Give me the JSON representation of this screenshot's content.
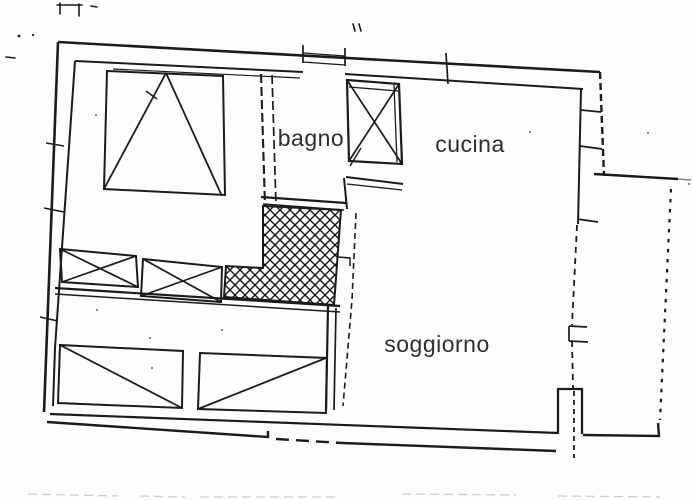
{
  "plan": {
    "rooms": [
      {
        "id": "bagno",
        "label": "bagno"
      },
      {
        "id": "cucina",
        "label": "cucina"
      },
      {
        "id": "soggiorno",
        "label": "soggiorno"
      }
    ]
  },
  "colors": {
    "ink": "#1b1b1b",
    "paper": "#fdfdfc",
    "label_text": "#2e2e2e",
    "scan_noise": "#b9b9b9"
  }
}
